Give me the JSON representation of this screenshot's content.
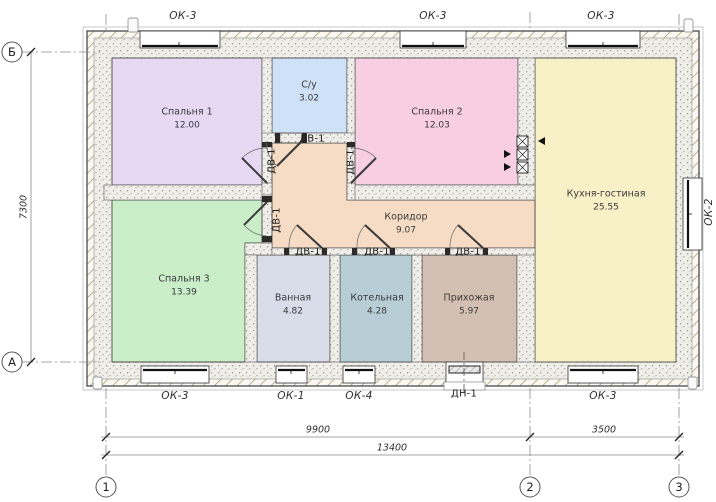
{
  "plan": {
    "title": "Floor plan",
    "rooms": [
      {
        "name": "Спальня 1",
        "area": "12.00",
        "fill": "#e7d8f4"
      },
      {
        "name": "С/у",
        "area": "3.02",
        "fill": "#cfe1f6"
      },
      {
        "name": "Спальня 2",
        "area": "12.03",
        "fill": "#f8cfe2"
      },
      {
        "name": "Кухня-гостиная",
        "area": "25.55",
        "fill": "#f8f1c7"
      },
      {
        "name": "Спальня 3",
        "area": "13.39",
        "fill": "#c9eec8"
      },
      {
        "name": "Ванная",
        "area": "4.82",
        "fill": "#d9dce9"
      },
      {
        "name": "Котельная",
        "area": "4.28",
        "fill": "#b8ced7"
      },
      {
        "name": "Прихожая",
        "area": "5.97",
        "fill": "#d4c0b2"
      },
      {
        "name": "Коридор",
        "area": "9.07",
        "fill": "#f6dcc4"
      }
    ],
    "openings": {
      "windows_top": [
        {
          "label": "ОК-3"
        },
        {
          "label": "ОК-3"
        },
        {
          "label": "ОК-3"
        }
      ],
      "window_right": {
        "label": "ОК-2"
      },
      "windows_bottom": [
        {
          "label": "ОК-3"
        },
        {
          "label": "ОК-1"
        },
        {
          "label": "ОК-4"
        },
        {
          "label": "ОК-3"
        }
      ],
      "entry_door": {
        "label": "ДН-1"
      },
      "interior_doors": [
        {
          "label": "ДВ-1"
        },
        {
          "label": "ДВ-1"
        },
        {
          "label": "ДВ-1"
        },
        {
          "label": "ДВ-1"
        },
        {
          "label": "ДВ-1"
        },
        {
          "label": "ДВ-1"
        },
        {
          "label": "ДВ-1"
        }
      ]
    },
    "axes": {
      "bottom": [
        {
          "label": "1"
        },
        {
          "label": "2"
        },
        {
          "label": "3"
        }
      ],
      "left": [
        {
          "label": "Б"
        },
        {
          "label": "А"
        }
      ]
    },
    "dimensions": {
      "bottom_spans": [
        {
          "value": "9900"
        },
        {
          "value": "3500"
        }
      ],
      "bottom_total": "13400",
      "left_height": "7300"
    },
    "drawing_colors": {
      "wall_outline": "#4a4a4a",
      "wall_fill_dots": "#8d8d8d",
      "hatch_line": "#a89f7d",
      "dim_line": "#8a8a8a"
    }
  }
}
